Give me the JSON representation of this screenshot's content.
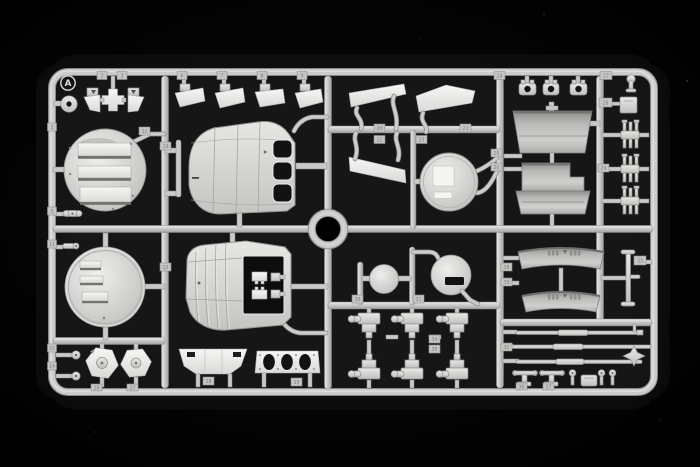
{
  "palette": {
    "background": "#000000",
    "plastic_base": "#cdcdcb",
    "plastic_highlight": "#f2f2f0",
    "plastic_shadow": "#8e8e8c",
    "funnel_band": "#a8a8a6",
    "opening_dark": "#121212"
  },
  "sprue": {
    "letter": "A",
    "tags": {
      "t1": "1",
      "t2": "2",
      "t3": "3",
      "t5": "5",
      "t6": "6",
      "t7": "7",
      "t8": "8",
      "t9": "9",
      "t10": "10",
      "t11": "11",
      "t12": "12",
      "t13": "13",
      "t14": "14",
      "t15": "15",
      "t16": "16",
      "t17": "17",
      "t18": "18",
      "t19": "19",
      "t20": "20",
      "t21": "21",
      "t22": "22",
      "t23": "23",
      "t24": "24",
      "t25": "25",
      "t26": "26",
      "t27": "27",
      "t28": "28",
      "t29": "29",
      "t30": "30",
      "t31": "31",
      "t32": "32",
      "t33": "33",
      "t34": "34",
      "t35": "35",
      "t36": "36",
      "t37": "37",
      "t38": "38",
      "t39": "39"
    }
  }
}
